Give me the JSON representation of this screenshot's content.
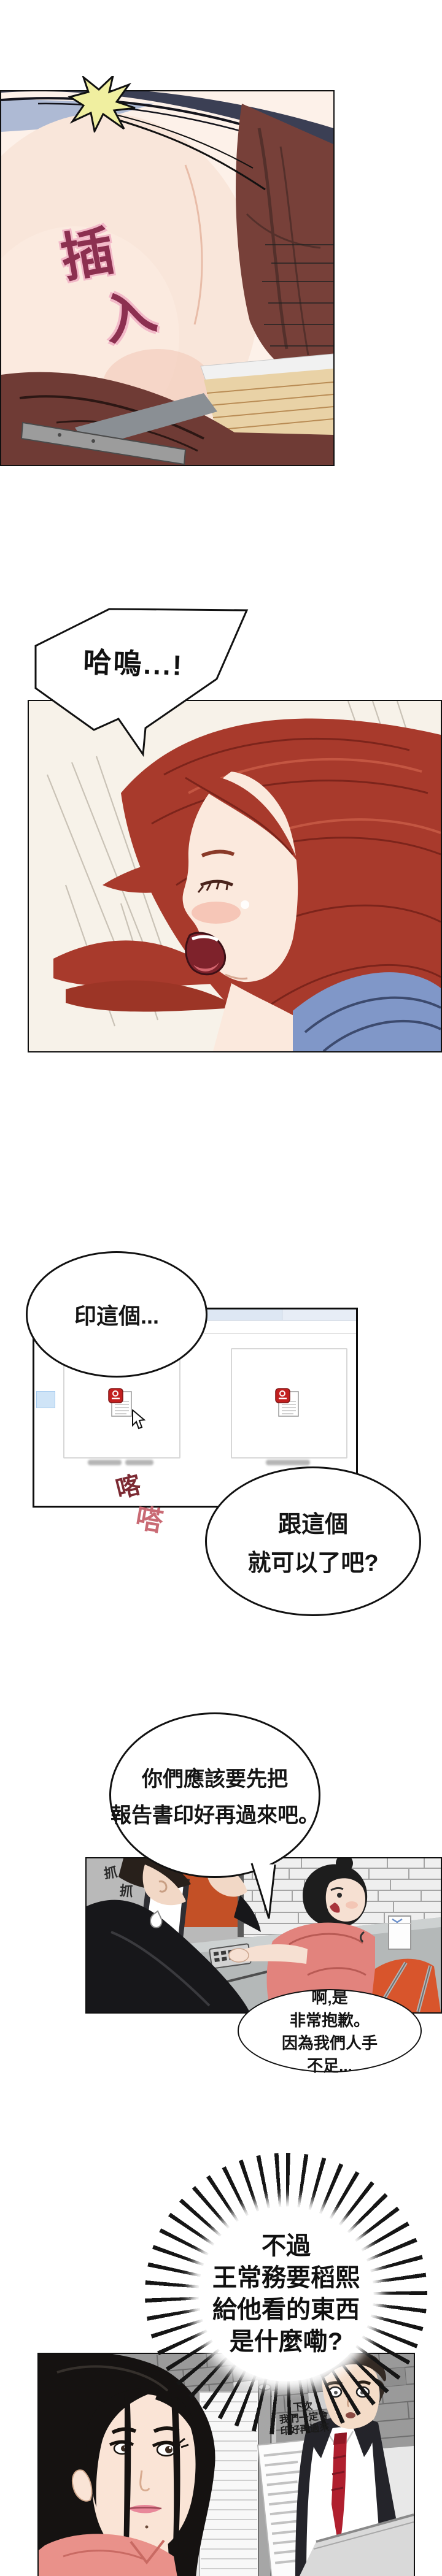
{
  "page": {
    "type": "webtoon-comic-page",
    "background": "#ffffff"
  },
  "panel1": {
    "sfx_insert": {
      "char1": "插",
      "char2": "入",
      "color": "#8c3050",
      "outline_color": "#f2b9c8"
    },
    "starburst_color": "#f0efa0"
  },
  "bubble_gasp": {
    "text": "哈嗚...!"
  },
  "bubble_print_this": {
    "text": "印這個..."
  },
  "file_window": {
    "kind": "file-explorer-screenshot",
    "titlebar_color": "#e3eaf5",
    "breadcrumb": {
      "folder_marker_color": "#e8c84a",
      "chevron1": "›",
      "chevron2": "›"
    },
    "files": [
      {
        "icon": "hwp-document-icon",
        "name_state": "blurred"
      },
      {
        "icon": "hwp-document-icon",
        "name_state": "blurred"
      }
    ],
    "hwp_icon_color": "#c21f1f",
    "selection_color": "#cfe4f7"
  },
  "sfx_typing": {
    "char1": "喀",
    "char2": "嗒",
    "color1": "#7c2a33",
    "color2": "#c96a74"
  },
  "bubble_with_this": {
    "line1": "跟這個",
    "line2": "就可以了吧?"
  },
  "bubble_should_print": {
    "line1": "你們應該要先把",
    "line2": "報告書印好再過來吧。"
  },
  "panel_office": {
    "sfx_scratch1": "抓",
    "sfx_scratch2": "抓"
  },
  "bubble_sorry": {
    "line1": "啊,是",
    "line2": "非常抱歉。",
    "line3": "因為我們人手",
    "line4": "不足..."
  },
  "burst": {
    "line1": "不過",
    "line2": "王常務要稻熙",
    "line3": "給他看的東西",
    "line4": "是什麼嘞?"
  },
  "panel_street": {
    "note_line1": "下次",
    "note_line2": "我們一定會",
    "note_line3": "印好再過來",
    "tie_color": "#b01f2e"
  },
  "icons": {
    "hwp-document-icon": "red rounded square badge on white page",
    "cursor-icon": "mouse arrow pointer",
    "folder-breadcrumb-icon": "yellow folder marker"
  }
}
